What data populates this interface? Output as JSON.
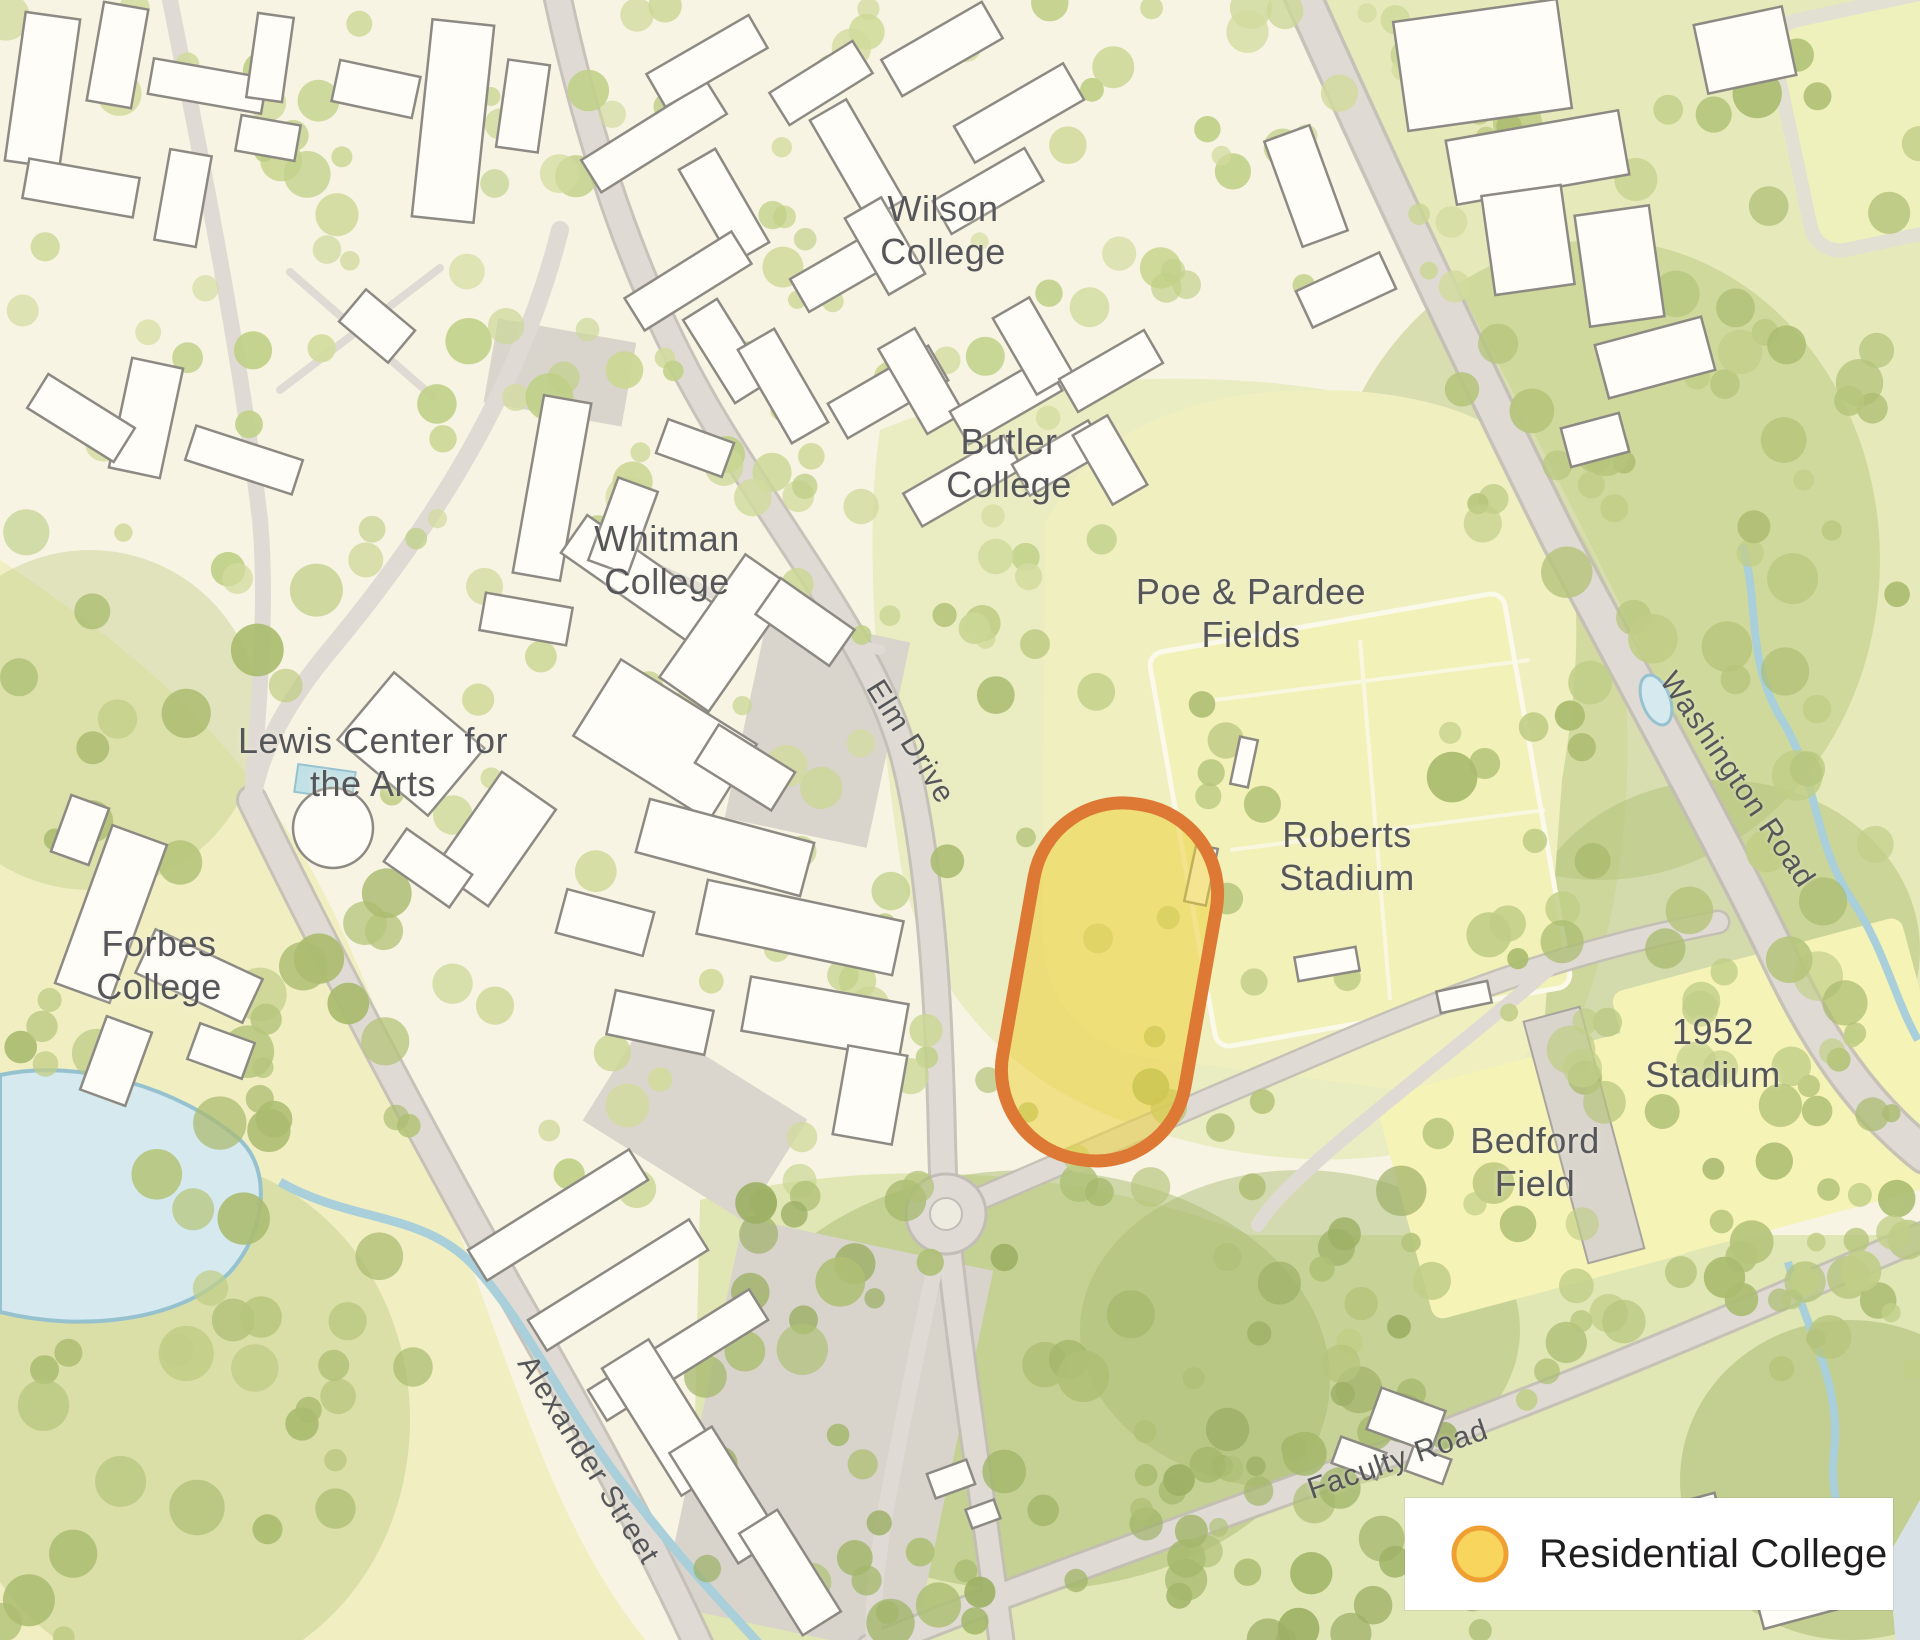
{
  "labels": {
    "wilson_college": "Wilson\nCollege",
    "butler_college": "Butler\nCollege",
    "whitman_college": "Whitman\nCollege",
    "lewis_center": "Lewis Center for\nthe Arts",
    "forbes_college": "Forbes\nCollege",
    "poe_pardee_fields": "Poe & Pardee\nFields",
    "roberts_stadium": "Roberts\nStadium",
    "stadium_1952": "1952\nStadium",
    "bedford_field": "Bedford\nField"
  },
  "road_labels": {
    "elm_drive": "Elm Drive",
    "washington_road": "Washington Road",
    "alexander_street": "Alexander Street",
    "faculty_road": "Faculty Road"
  },
  "legend": {
    "label": "Residential College",
    "marker_fill": "#F8D55C",
    "marker_stroke": "#F0A032"
  },
  "highlight": {
    "fill": "#EDD23E",
    "stroke": "#DE7935"
  },
  "colors": {
    "label_text": "#55565A",
    "legend_text": "#1F1D1E",
    "water": "#D5E9EE",
    "road": "#DFDBD4",
    "field": "#F2F1B8",
    "building": "#FEFDF8"
  }
}
